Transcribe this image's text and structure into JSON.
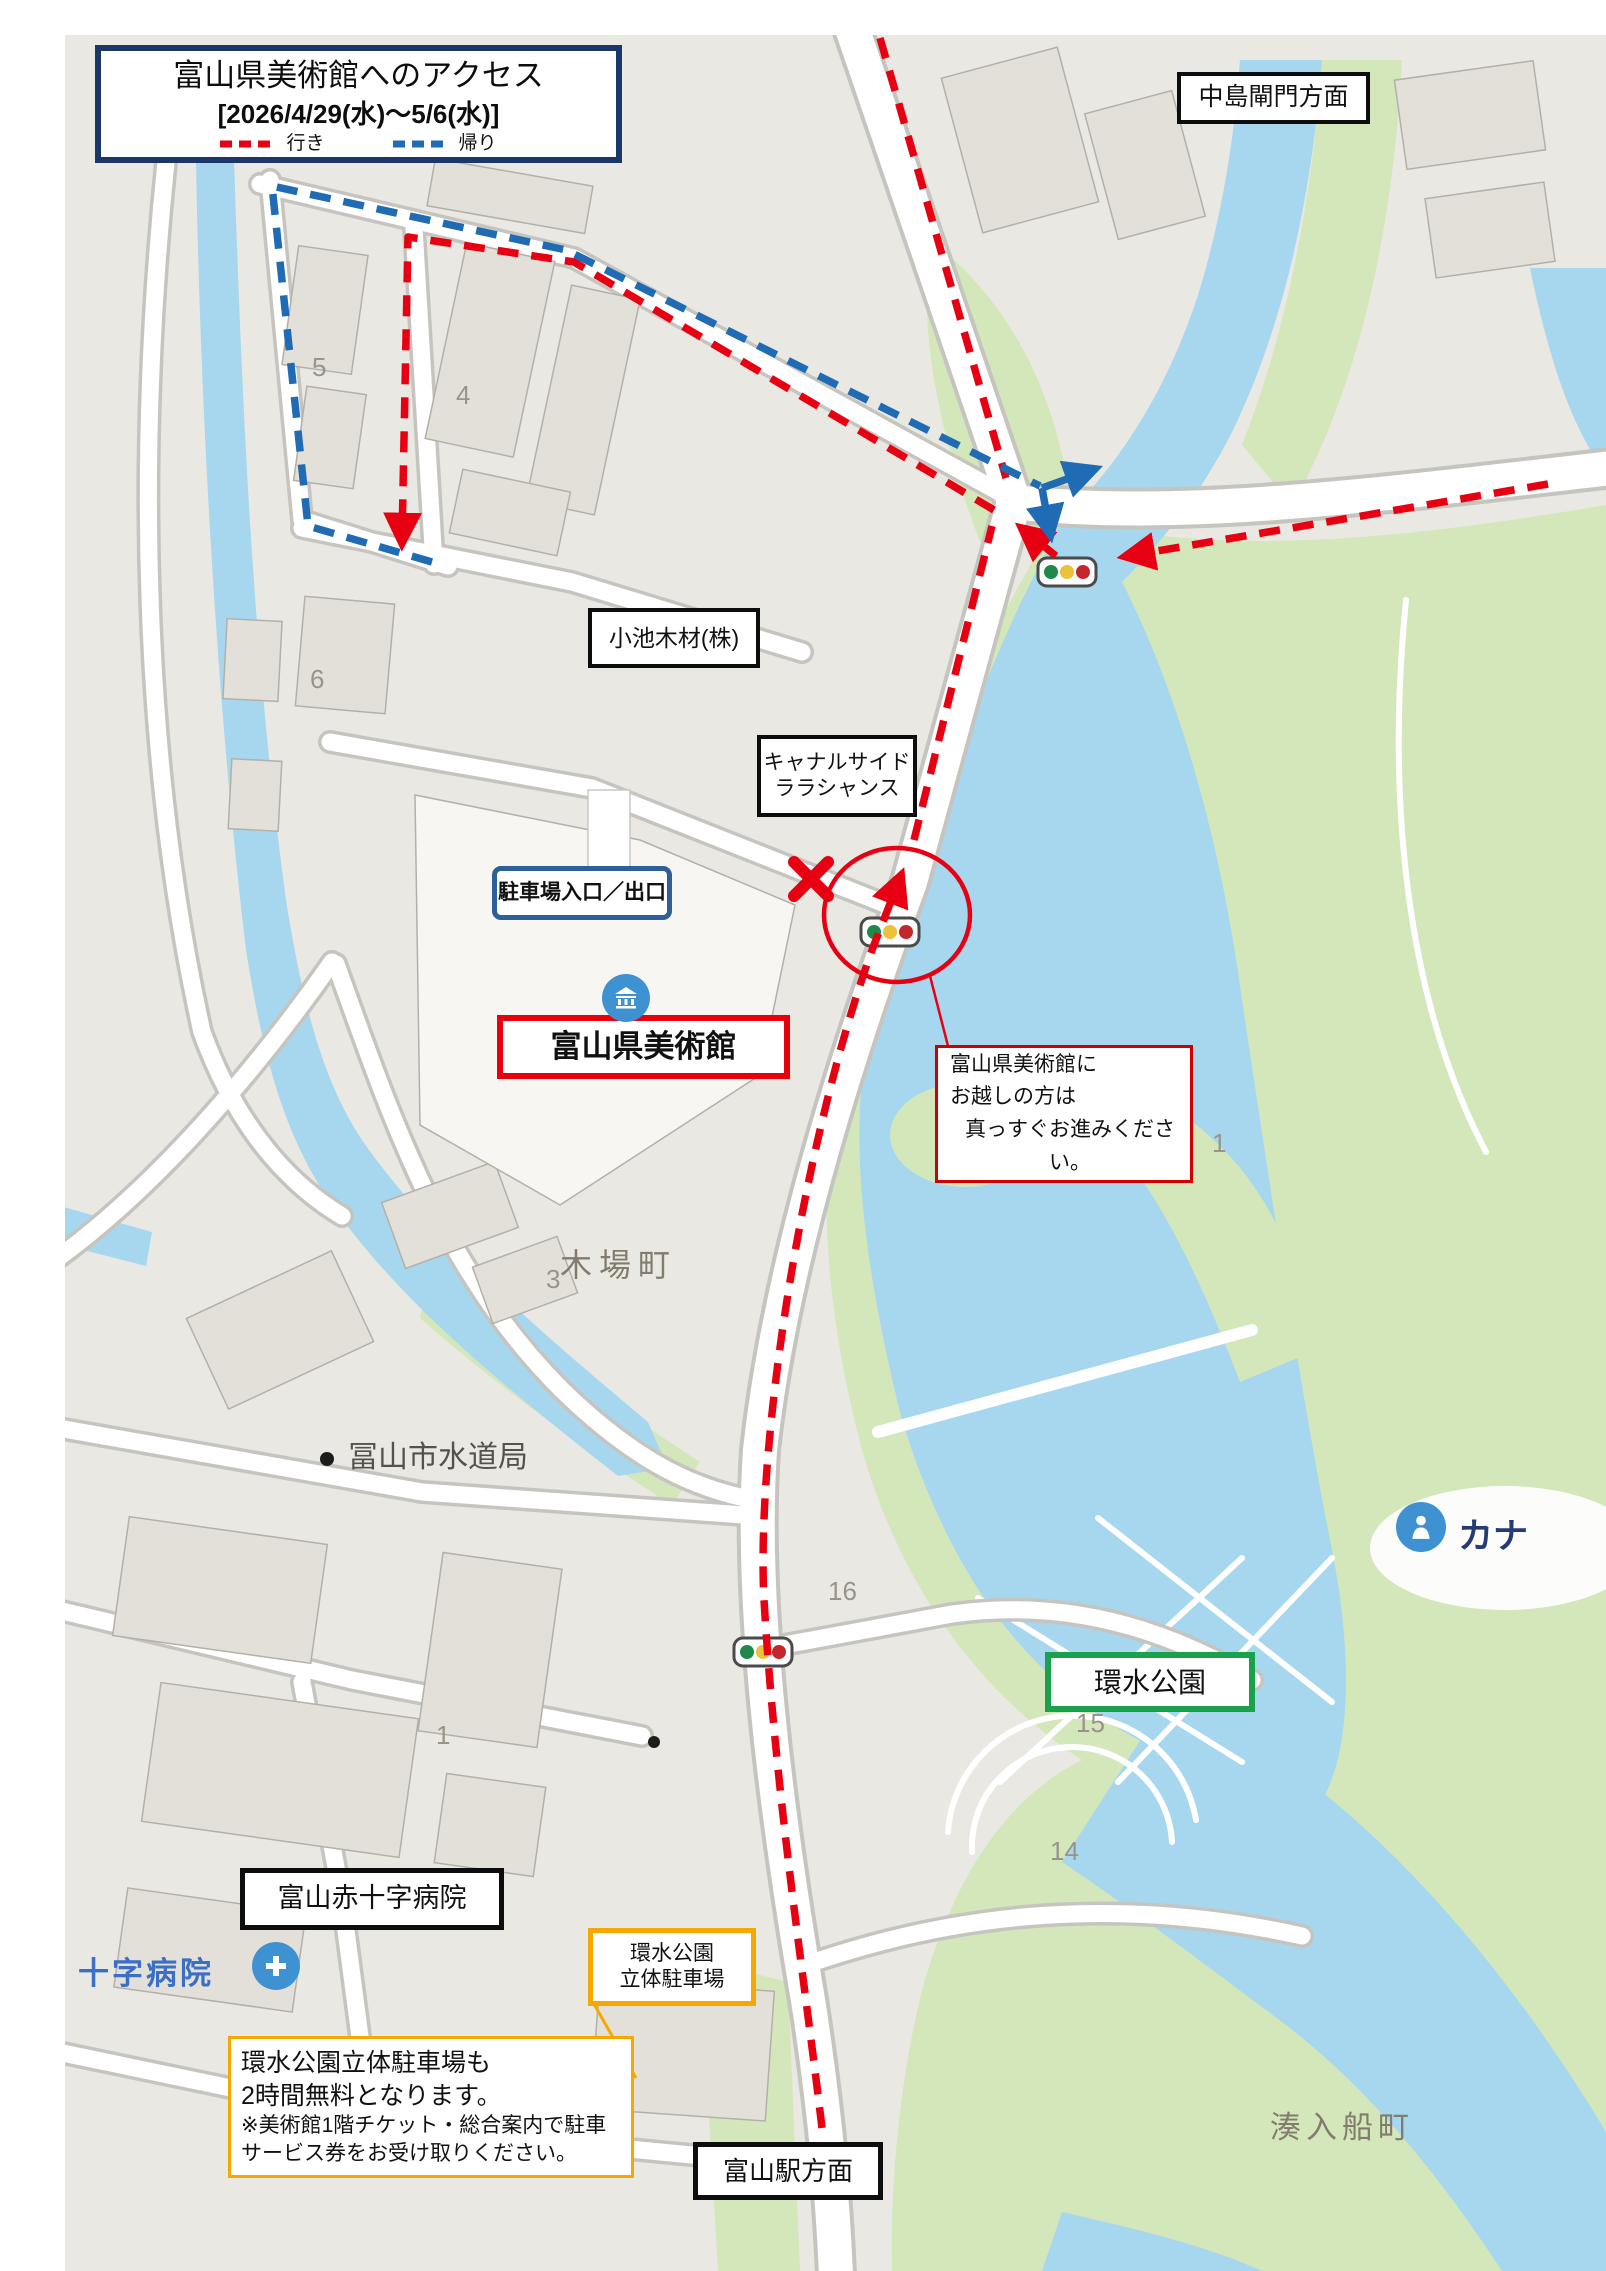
{
  "title_box": {
    "title": "富山県美術館へのアクセス",
    "date_range": "[2026/4/29(水)～5/6(水)]",
    "legend": {
      "going_label": "行き",
      "return_label": "帰り",
      "going_color": "#e60012",
      "return_color": "#1f6cb5"
    }
  },
  "labels": {
    "nakajima_lock": "中島閘門方面",
    "koike_lumber": "小池木材(株)",
    "canalside_line1": "キャナルサイド",
    "canalside_line2": "ララシャンス",
    "parking_gate": "駐車場入口／出口",
    "museum": "富山県美術館",
    "guide_note_line1": "富山県美術館に",
    "guide_note_line2": "お越しの方は",
    "guide_note_line3": "真っすぐお進みください。",
    "kansui_park": "環水公園",
    "red_cross_hospital": "富山赤十字病院",
    "kansui_parking_line1": "環水公園",
    "kansui_parking_line2": "立体駐車場",
    "toyama_station": "富山駅方面",
    "info_note_line1": "環水公園立体駐車場も",
    "info_note_line2": "2時間無料となります。",
    "info_note_line3": "※美術館1階チケット・総合案内で駐車",
    "info_note_line4": "サービス券をお受け取りください。"
  },
  "map_labels": {
    "kibamachi": "木場町",
    "waterworks": "冨山市水道局",
    "minato_irifune": "湊入船町",
    "hospital_partial": "十字病院",
    "kana_partial": "カナ",
    "block_numbers": [
      "5",
      "4",
      "6",
      "3",
      "16",
      "15",
      "14",
      "1",
      "1"
    ]
  },
  "map_colors": {
    "water": "#a6d7ef",
    "park_green": "#d3e7ba",
    "urban": "#eae8e3",
    "museum_box_border": "#e8000d",
    "kansui_box_border": "#1aa14b",
    "parking_box_border": "#f5a800",
    "parking_gate_border": "#2e5f96",
    "title_border": "#1b3668"
  }
}
